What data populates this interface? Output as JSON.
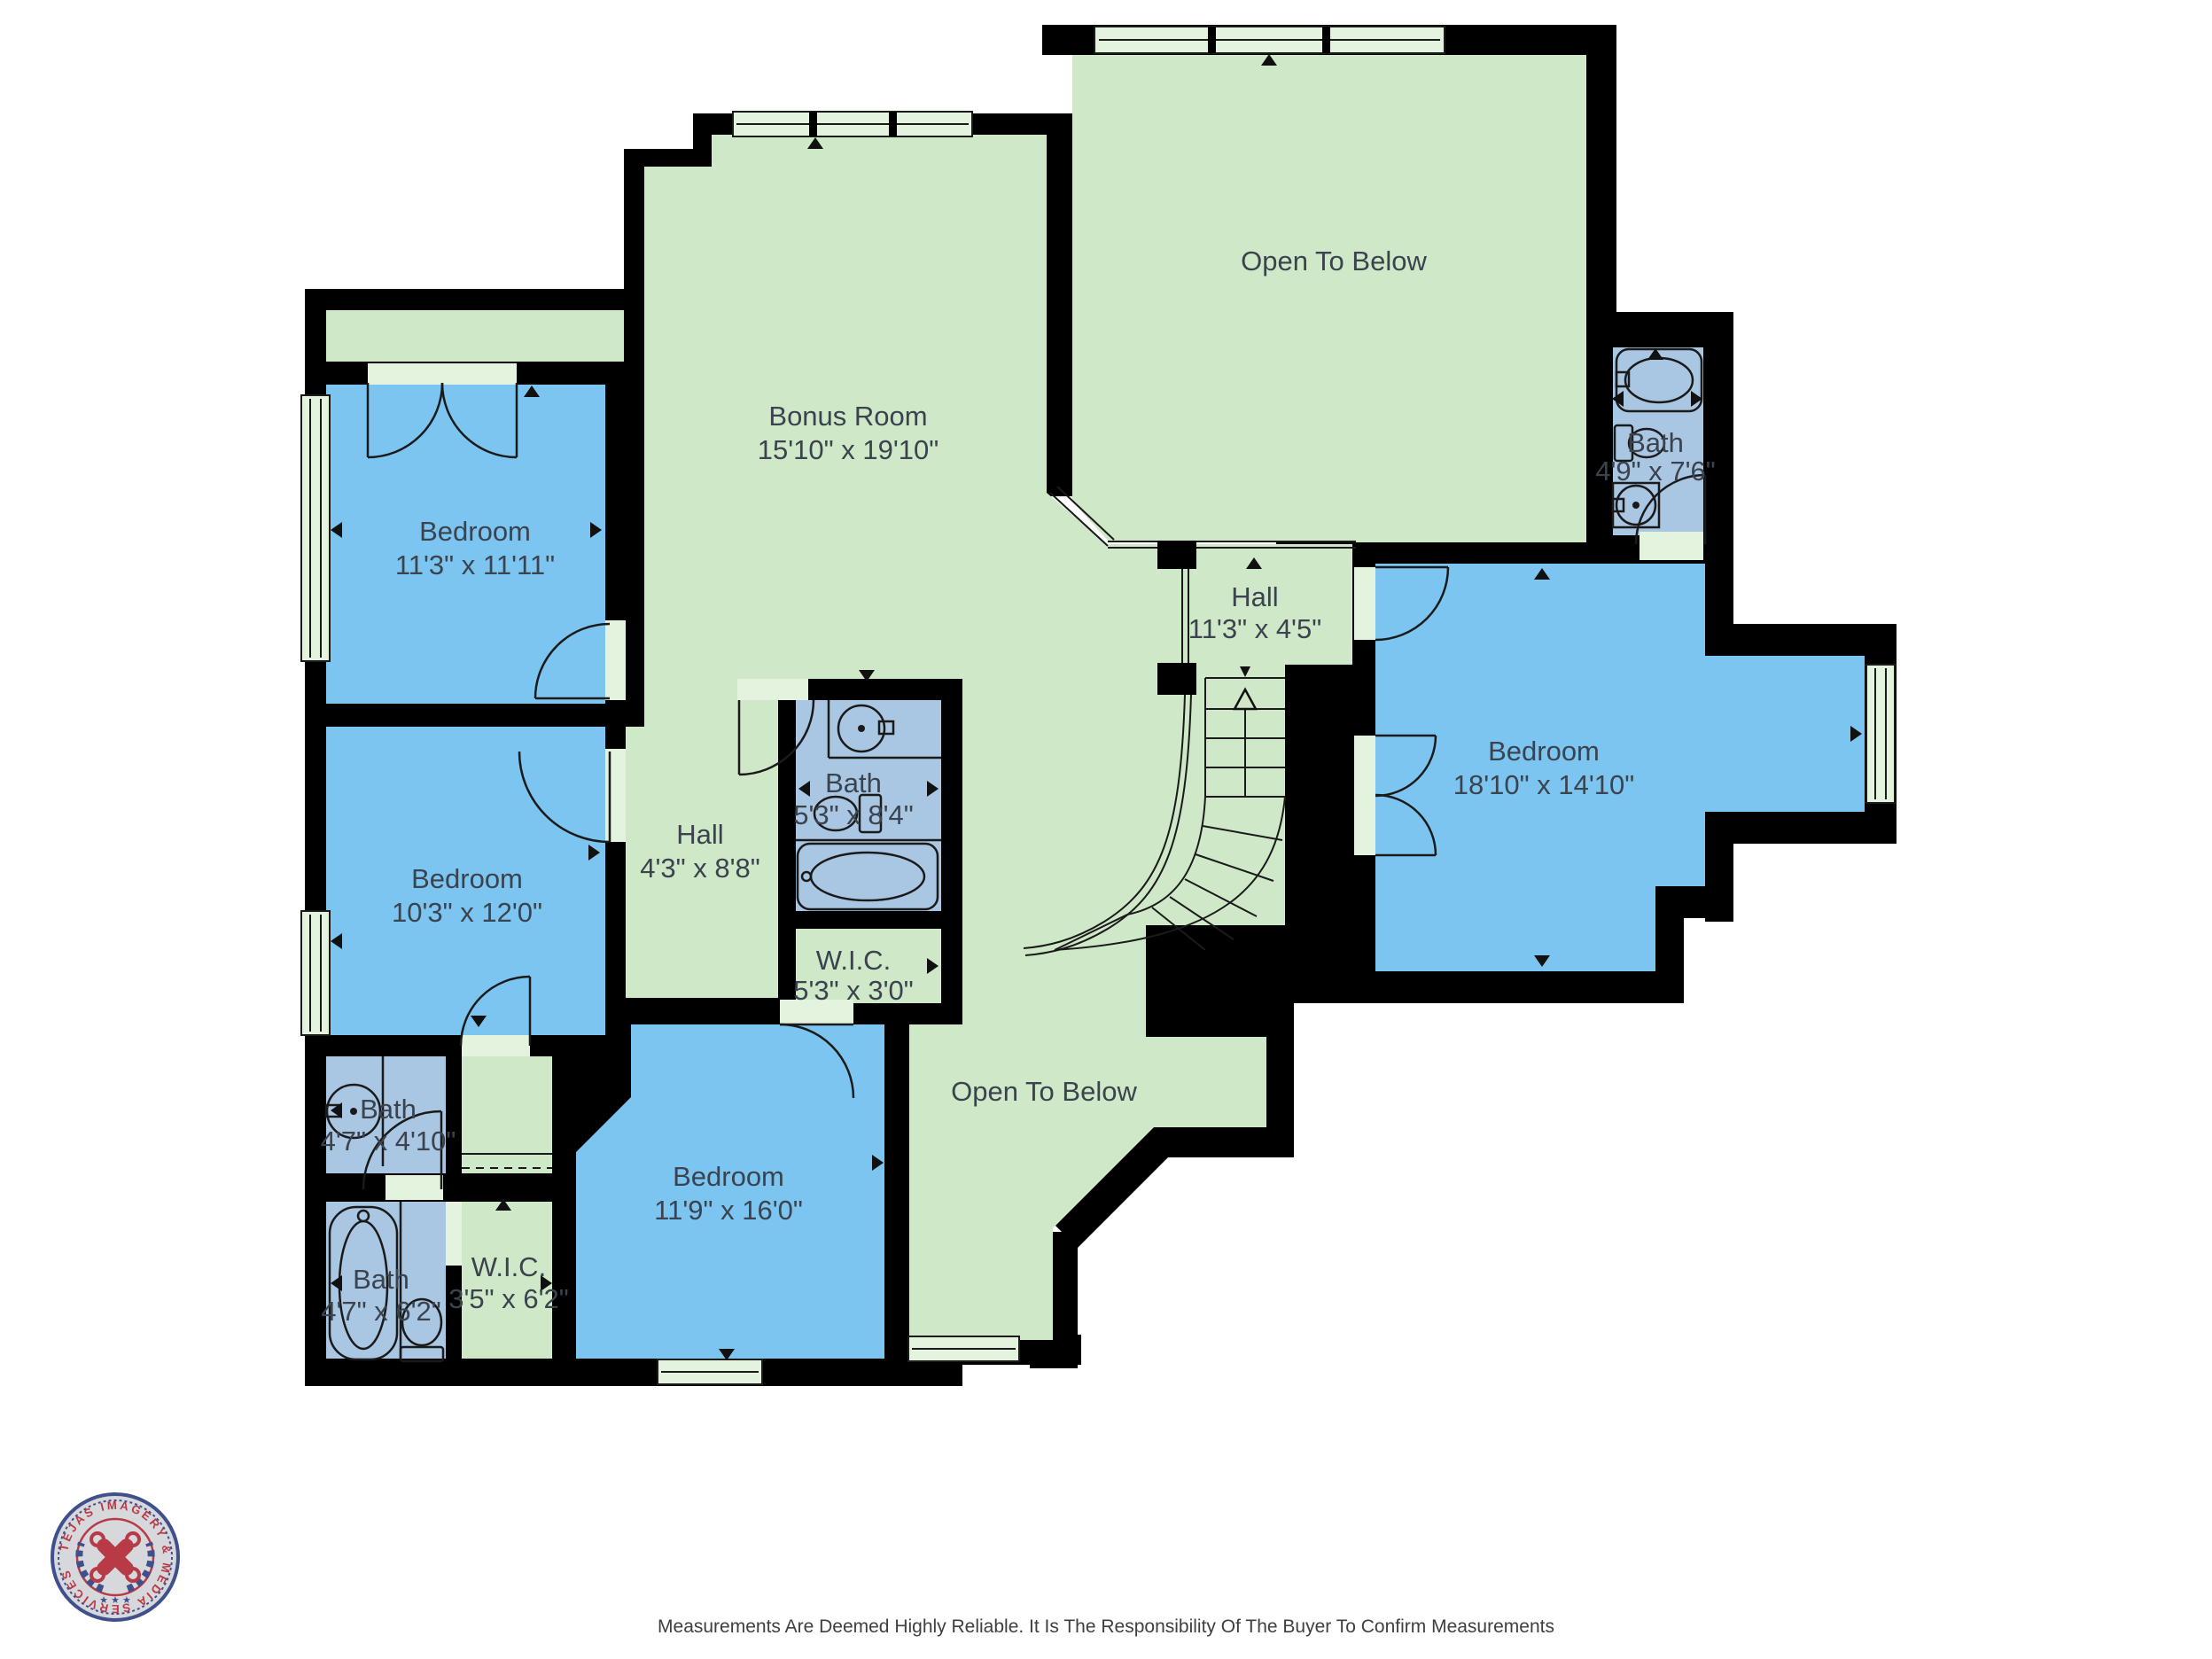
{
  "colors": {
    "wall": "#000000",
    "open_area_green": "#cfe9c8",
    "bedroom_blue": "#7cc5f1",
    "bath_blue": "#a9c6e2",
    "window_green": "#e4f3dd",
    "label_text": "#3a434e",
    "logo_navy": "#3f508c",
    "logo_red": "#b83a46"
  },
  "rooms": [
    {
      "name": "Bonus Room",
      "dims": "15'10\" x 19'10\""
    },
    {
      "name": "Open To Below",
      "dims": ""
    },
    {
      "name": "Bedroom",
      "dims": "11'3\" x 11'11\""
    },
    {
      "name": "Bedroom",
      "dims": "10'3\" x 12'0\""
    },
    {
      "name": "Bath",
      "dims": "4'7\" x 4'10\""
    },
    {
      "name": "Bath",
      "dims": "4'7\" x 6'2\""
    },
    {
      "name": "W.I.C.",
      "dims": "3'5\" x 6'2\""
    },
    {
      "name": "Bedroom",
      "dims": "11'9\" x 16'0\""
    },
    {
      "name": "Hall",
      "dims": "4'3\" x 8'8\""
    },
    {
      "name": "Bath",
      "dims": "5'3\" x 8'4\""
    },
    {
      "name": "W.I.C.",
      "dims": "5'3\" x 3'0\""
    },
    {
      "name": "Hall",
      "dims": "11'3\" x 4'5\""
    },
    {
      "name": "Bath",
      "dims": "4'9\" x 7'6\""
    },
    {
      "name": "Bedroom",
      "dims": "18'10\" x 14'10\""
    },
    {
      "name": "Open To Below",
      "dims": ""
    }
  ],
  "footer": {
    "disclaimer": "Measurements Are Deemed Highly Reliable. It Is The Responsibility Of The Buyer To Confirm Measurements"
  },
  "logo": {
    "text": "TEJAS IMAGERY & MEDIA SERVICES",
    "stars": "★ ★ ★"
  }
}
